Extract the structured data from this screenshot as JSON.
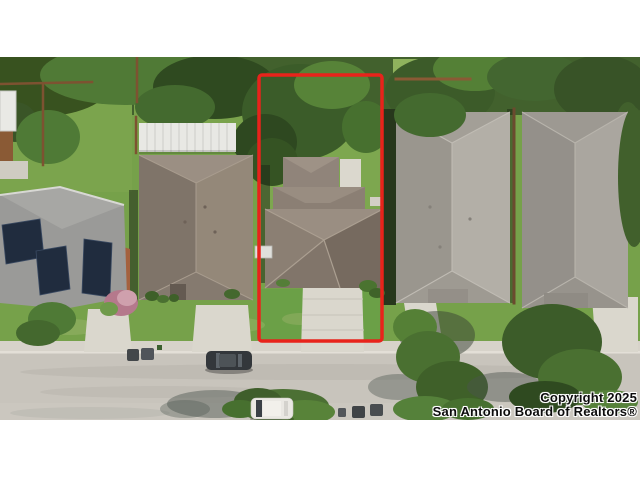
{
  "watermark": {
    "line1": "Copyright 2025",
    "line2": "San Antonio Board of Realtors®"
  },
  "listing_outline": {
    "color": "#e8231b"
  },
  "palette": {
    "grass": "#76a14a",
    "subject_lawn": "#6ba047",
    "tree_canopy": "#42612d",
    "street": "#c8c4bc",
    "sidewalk": "#d7d3ca",
    "driveway": "#dad7cd",
    "subject_roof": "#8b7f73",
    "neighbor_roof_taupe": "#8a7e74",
    "neighbor_roof_light_gray": "#a9a59d",
    "neighbor_roof_gray": "#a09c95",
    "solar_panel": "#202c3e",
    "fence": "#7d5231",
    "shed_white": "#e8e8e4",
    "dark_car": "#33373b",
    "white_car": "#eae8e3"
  }
}
